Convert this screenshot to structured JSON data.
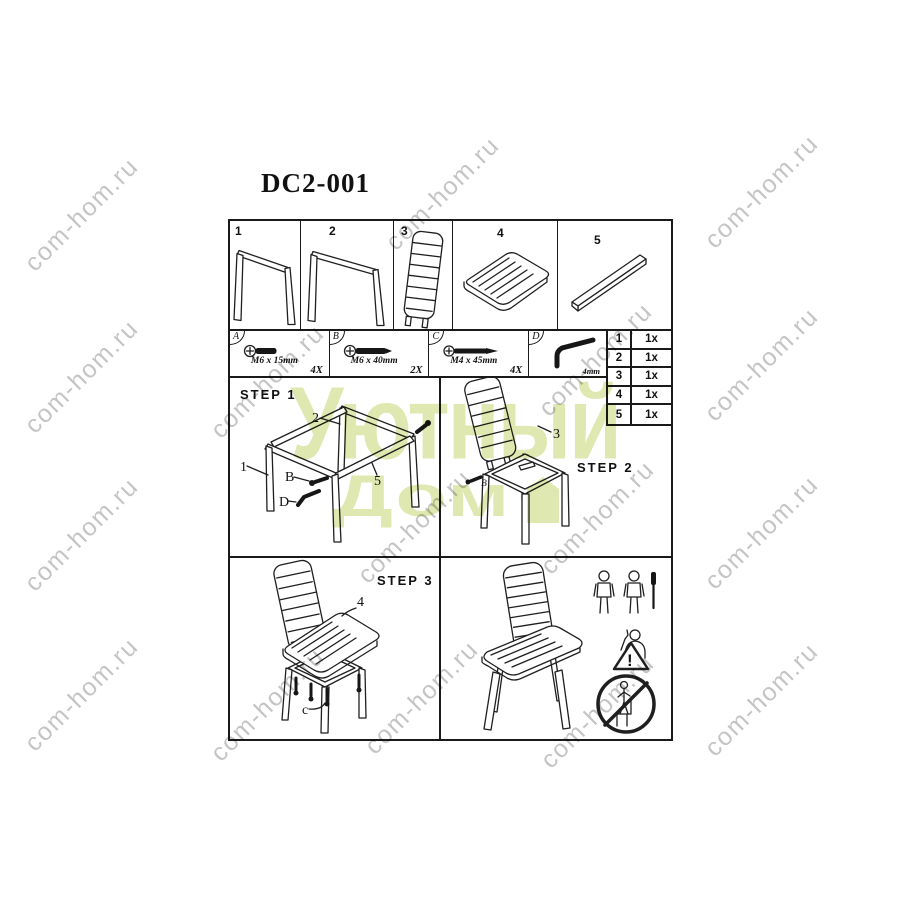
{
  "watermark": {
    "text": "com-hom.ru",
    "color": "rgba(148,148,148,0.55)",
    "positions": [
      [
        82,
        215
      ],
      [
        443,
        194
      ],
      [
        762,
        192
      ],
      [
        82,
        377
      ],
      [
        268,
        382
      ],
      [
        596,
        360
      ],
      [
        762,
        365
      ],
      [
        82,
        535
      ],
      [
        415,
        527
      ],
      [
        598,
        518
      ],
      [
        762,
        533
      ],
      [
        82,
        695
      ],
      [
        268,
        705
      ],
      [
        422,
        698
      ],
      [
        598,
        712
      ],
      [
        762,
        700
      ]
    ]
  },
  "brand": {
    "line1": "Уютный",
    "line2": "Дом",
    "color": "#dce6a9"
  },
  "doc": {
    "title": "DC2-001",
    "parts": [
      {
        "num": "1"
      },
      {
        "num": "2"
      },
      {
        "num": "3"
      },
      {
        "num": "4"
      },
      {
        "num": "5"
      }
    ],
    "hardware": [
      {
        "id": "A",
        "size": "M6 x 15mm",
        "qty": "4X"
      },
      {
        "id": "B",
        "size": "M6 x 40mm",
        "qty": "2X"
      },
      {
        "id": "C",
        "size": "M4 x 45mm",
        "qty": "4X"
      },
      {
        "id": "D",
        "size": "4mm",
        "qty": ""
      }
    ],
    "quantity_table": [
      {
        "part": "1",
        "count": "1x"
      },
      {
        "part": "2",
        "count": "1x"
      },
      {
        "part": "3",
        "count": "1x"
      },
      {
        "part": "4",
        "count": "1x"
      },
      {
        "part": "5",
        "count": "1x"
      }
    ],
    "steps": {
      "step1": {
        "label": "STEP 1",
        "callout_1": "1",
        "callout_2": "2",
        "callout_5": "5",
        "callout_B": "B",
        "callout_D": "D"
      },
      "step2": {
        "label": "STEP 2",
        "callout_3": "3",
        "callout_B": "B"
      },
      "step3": {
        "label": "STEP 3",
        "callout_4": "4",
        "callout_C": "c"
      }
    }
  }
}
